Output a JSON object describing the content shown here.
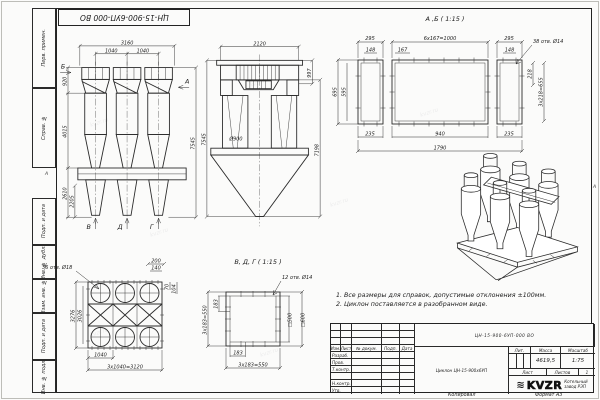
{
  "stamp": {
    "doc_number_rotated": "ЦН-15-900-6УП-000 ВО"
  },
  "margin": {
    "labels": [
      "Перв. примен.",
      "Справ. №",
      "Подп. и дата",
      "Инв. № дубл.",
      "Взам. инв. №",
      "Подп. и дата",
      "Инв. № подл."
    ],
    "zone_left": "А",
    "zone_right": "А"
  },
  "views": {
    "front": {
      "dim_3160": "3160",
      "dim_1040_left": "1040",
      "dim_1040_right": "1040",
      "dim_920": "920",
      "dim_4015": "4015",
      "dim_2610": "2610",
      "dim_2205": "2205",
      "dim_7545": "7545",
      "arrow_b": "Б",
      "arrow_a": "А",
      "arrow_v": "В",
      "arrow_d": "Д",
      "arrow_g": "Г"
    },
    "side": {
      "dim_2120": "2120",
      "dim_997": "997",
      "dim_d900": "Ø900",
      "dim_7545": "7545",
      "dim_7198": "7198"
    },
    "ab": {
      "title": "А ,Б ( 1:15 )",
      "dim_295_left": "295",
      "dim_6x167": "6x167=1000",
      "dim_295_right": "295",
      "dim_148_left": "148",
      "dim_167": "167",
      "dim_148_right": "148",
      "holes_note": "38 отв. Ø14",
      "dim_218": "218",
      "dim_3x218": "3x218=655",
      "dim_695": "695",
      "dim_595": "595",
      "dim_235_left": "235",
      "dim_940": "940",
      "dim_235_right": "235",
      "dim_1790": "1790"
    },
    "plan": {
      "holes_note": "36 отв. Ø18",
      "dim_200": "200",
      "dim_140": "140",
      "dim_70": "70",
      "dim_104": "104",
      "dim_3276": "3276",
      "dim_3026": "3026",
      "dim_1040": "1040",
      "dim_3x1040": "3x1040=3120"
    },
    "vdg": {
      "title": "В, Д, Г ( 1:15 )",
      "holes_note": "12 отв. Ø14",
      "dim_183_left": "183",
      "dim_3x183_left": "3x183=550",
      "dim_sq500": "□500",
      "dim_sq600": "□600",
      "dim_183_bottom": "183",
      "dim_3x183_bottom": "3x183=550"
    }
  },
  "notes": {
    "line1": "1. Все размеры для справок, допустимые отклонения ±100мм.",
    "line2": "2. Циклон поставляется в разобранном виде."
  },
  "title_block": {
    "doc_number": "ЦН-15-900-6УП-000 ВО",
    "product_name": "Циклон ЦН-15-900х6УП",
    "col_izm": "Изм.",
    "col_list": "Лист",
    "col_doc": "№ докум.",
    "col_sign": "Подп.",
    "col_date": "Дата",
    "row_developed": "Разраб.",
    "row_checked": "Пров.",
    "row_tcontrol": "Т.контр.",
    "row_ncontrol": "Н.контр.",
    "row_approved": "Утв.",
    "lit_label": "Лит.",
    "mass_label": "Масса",
    "scale_label": "Масштаб",
    "mass_value": "4619,5",
    "scale_value": "1:75",
    "sheet_label": "Лист",
    "sheets_label": "Листов",
    "sheets_value": "1",
    "logo_text": "KVZR",
    "spring_glyph": "≋",
    "company_line1": "Котельный",
    "company_line2": "завод РЭП"
  },
  "footer": {
    "copied_label": "Копировал",
    "format_label": "Формат А3"
  },
  "watermark": "kvzr.ru"
}
